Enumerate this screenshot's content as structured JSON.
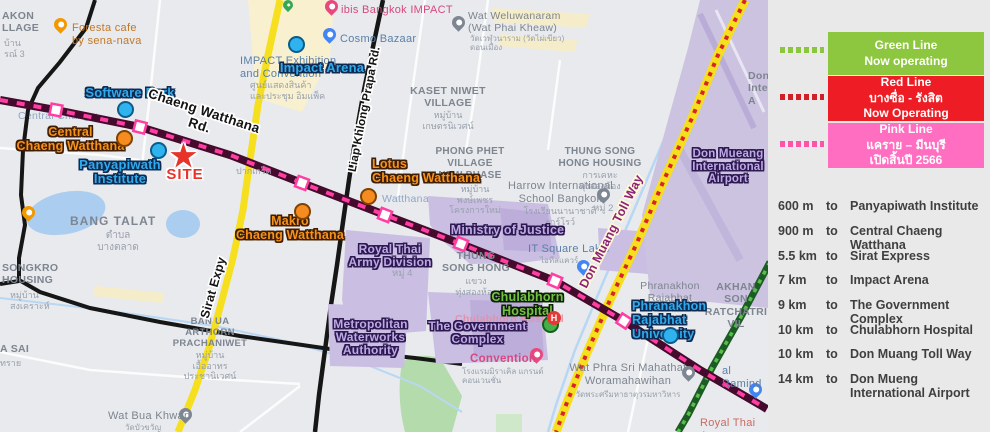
{
  "colors": {
    "green_line": "#8dc63f",
    "red_line": "#ee1c24",
    "pink_line_box": "#ff6ec0",
    "pink_line_dash": "#ff3da2",
    "yellow_road": "#f6df1e",
    "site_red": "#e8332a",
    "purple_area": "#cabee3"
  },
  "panel": {
    "legend": [
      {
        "title": "Green Line",
        "status": "Now operating",
        "color": "#8dc63f"
      },
      {
        "title": "Red Line",
        "line2": "บางซื่อ - รังสิต",
        "status": "Now Operating",
        "color": "#ee1c24"
      },
      {
        "title": "Pink Line",
        "line2": "แคราย – มีนบุรี",
        "status": "เปิดสิ้นปี  2566",
        "color": "#ff6ec0"
      }
    ],
    "distances": [
      {
        "d": "600 m",
        "to": "to",
        "p": "Panyapiwath Institute"
      },
      {
        "d": "900 m",
        "to": "to",
        "p": "Central Chaeng Watthana"
      },
      {
        "d": "5.5 km",
        "to": "to",
        "p": "Sirat Express"
      },
      {
        "d": "7 km",
        "to": "to",
        "p": "Impact Arena"
      },
      {
        "d": "9 km",
        "to": "to",
        "p": "The Government Complex"
      },
      {
        "d": "10 km",
        "to": "to",
        "p": "Chulabhorn Hospital"
      },
      {
        "d": "10 km",
        "to": "to",
        "p": "Don Muang Toll Way"
      },
      {
        "d": "14 km",
        "to": "to",
        "p": "Don Mueng International Airport"
      }
    ]
  },
  "map": {
    "site": "SITE",
    "annotations": {
      "software_park": "Software Park",
      "impact_arena": "Impact Arena",
      "central": "Central\nChaeng Watthana",
      "panyapiwath": "Panyapiwath\nInstitute",
      "lotus": "Lotus\nChaeng Watthana",
      "makro": "Makro\nChaeng Watthana",
      "ministry": "Ministry of Justice",
      "army": "Royal Thai\nArmy Division",
      "gov": "The Government\nComplex",
      "waterworks": "Metropolitan\nWaterworks\nAuthority",
      "chulabhorn": "Chulabhorn\nHospital",
      "phranakhon": "Phranakhon\nRajabhat University",
      "airport": "Don Mueang\nInternational\nAirport"
    },
    "roads": {
      "chaeng_watthana": "Chaeng Watthana Rd.",
      "liap": "Liap Khlong Prapa Rd.",
      "toll": "Don Muang Toll Way",
      "sirat": "Sirat Expy"
    },
    "texts": {
      "nakon": "AKON\nLLAGE",
      "nakon_th": "บ้าน\nรณ์ 3",
      "foresta": "Foresta cafe\nby sena-nava",
      "ibis": "ibis Bangkok IMPACT",
      "cosmo": "Cosmo Bazaar",
      "impact_ex": "IMPACT Exhibition\nand Convention",
      "impact_ex_th": "ศูนย์แสดงสินค้า\nและประชุม อิมแพ็ค",
      "wat_welu": "Wat Weluwanaram\n(Wat Phai Kheaw)",
      "wat_welu_th": "วัดเวฬุวนาราม (วัดไผ่เขียว)\nดอนเมือง",
      "kaset": "KASET NIWET\nVILLAGE",
      "kaset_th": "หมู่บ้าน\nเกษตรนิเวศน์",
      "phong": "PHONG PHET\nVILLAGE\nNEW PHASE",
      "phong_th": "หมู่บ้าน\nพงษ์เพชร\nโครงการใหม่",
      "harrow": "Harrow International\nSchool Bangkok",
      "harrow_th": "โรงเรียนนานาชาติ\nฮาร์โรว์",
      "thung_housing": "THUNG SONG\nHONG HOUSING",
      "thung_housing_th": "การเคหะ\nทุ่งสองห้อง",
      "mu2": "หมู่ 2",
      "mu4": "หมู่ 4",
      "bang_talat": "BANG TALAT",
      "bang_talat_th": "ตำบล\nบางตลาด",
      "songkro": "SONGKRO\nHOUSING",
      "songkro_th": "หมู่บ้าน\nสงเคราะห์",
      "sa_sai": "A SAI",
      "sa_sai_th": "ทราย",
      "ban_ua": "BAN UA\nARTHORN\nPRACHANIWET",
      "ban_ua_th": "หมู่บ้าน\nเอื้ออาทร\nประชานิเวศน์",
      "wat_bua": "Wat Bua Khwan",
      "wat_bua_th": "วัดบัวขวัญ",
      "thung_song": "THUNG\nSONG HONG",
      "thung_song_th": "แขวง\nทุ่งสองห้อง",
      "it_square": "IT Square Laksi",
      "it_square_th": "ไอทีสแควร์",
      "phranakhon_grey": "Phranakhon\nRajabhat",
      "akhan": "AKHAN SON\nRATCHATRI\nVIL",
      "al_ramind": "al Ramind",
      "wat_phra": "Wat Phra Sri Mahathat\nWoramahawihan",
      "wat_phra_th": "วัดพระศรีมหาธาตุวรมหาวิหาร",
      "royal_arm": "Royal Thai Arm",
      "watthana": "Watthana",
      "central_ch": "Central Changw",
      "pak_kret": "ปากเกร็ด",
      "chula_faint": "Chulabhorn Hospital",
      "convention": "Convention",
      "convention_th": "โรงแรมมิราเคิล แกรนด์\nคอนเวนชั่น",
      "don_inte": "Don\nInte\nA"
    }
  }
}
